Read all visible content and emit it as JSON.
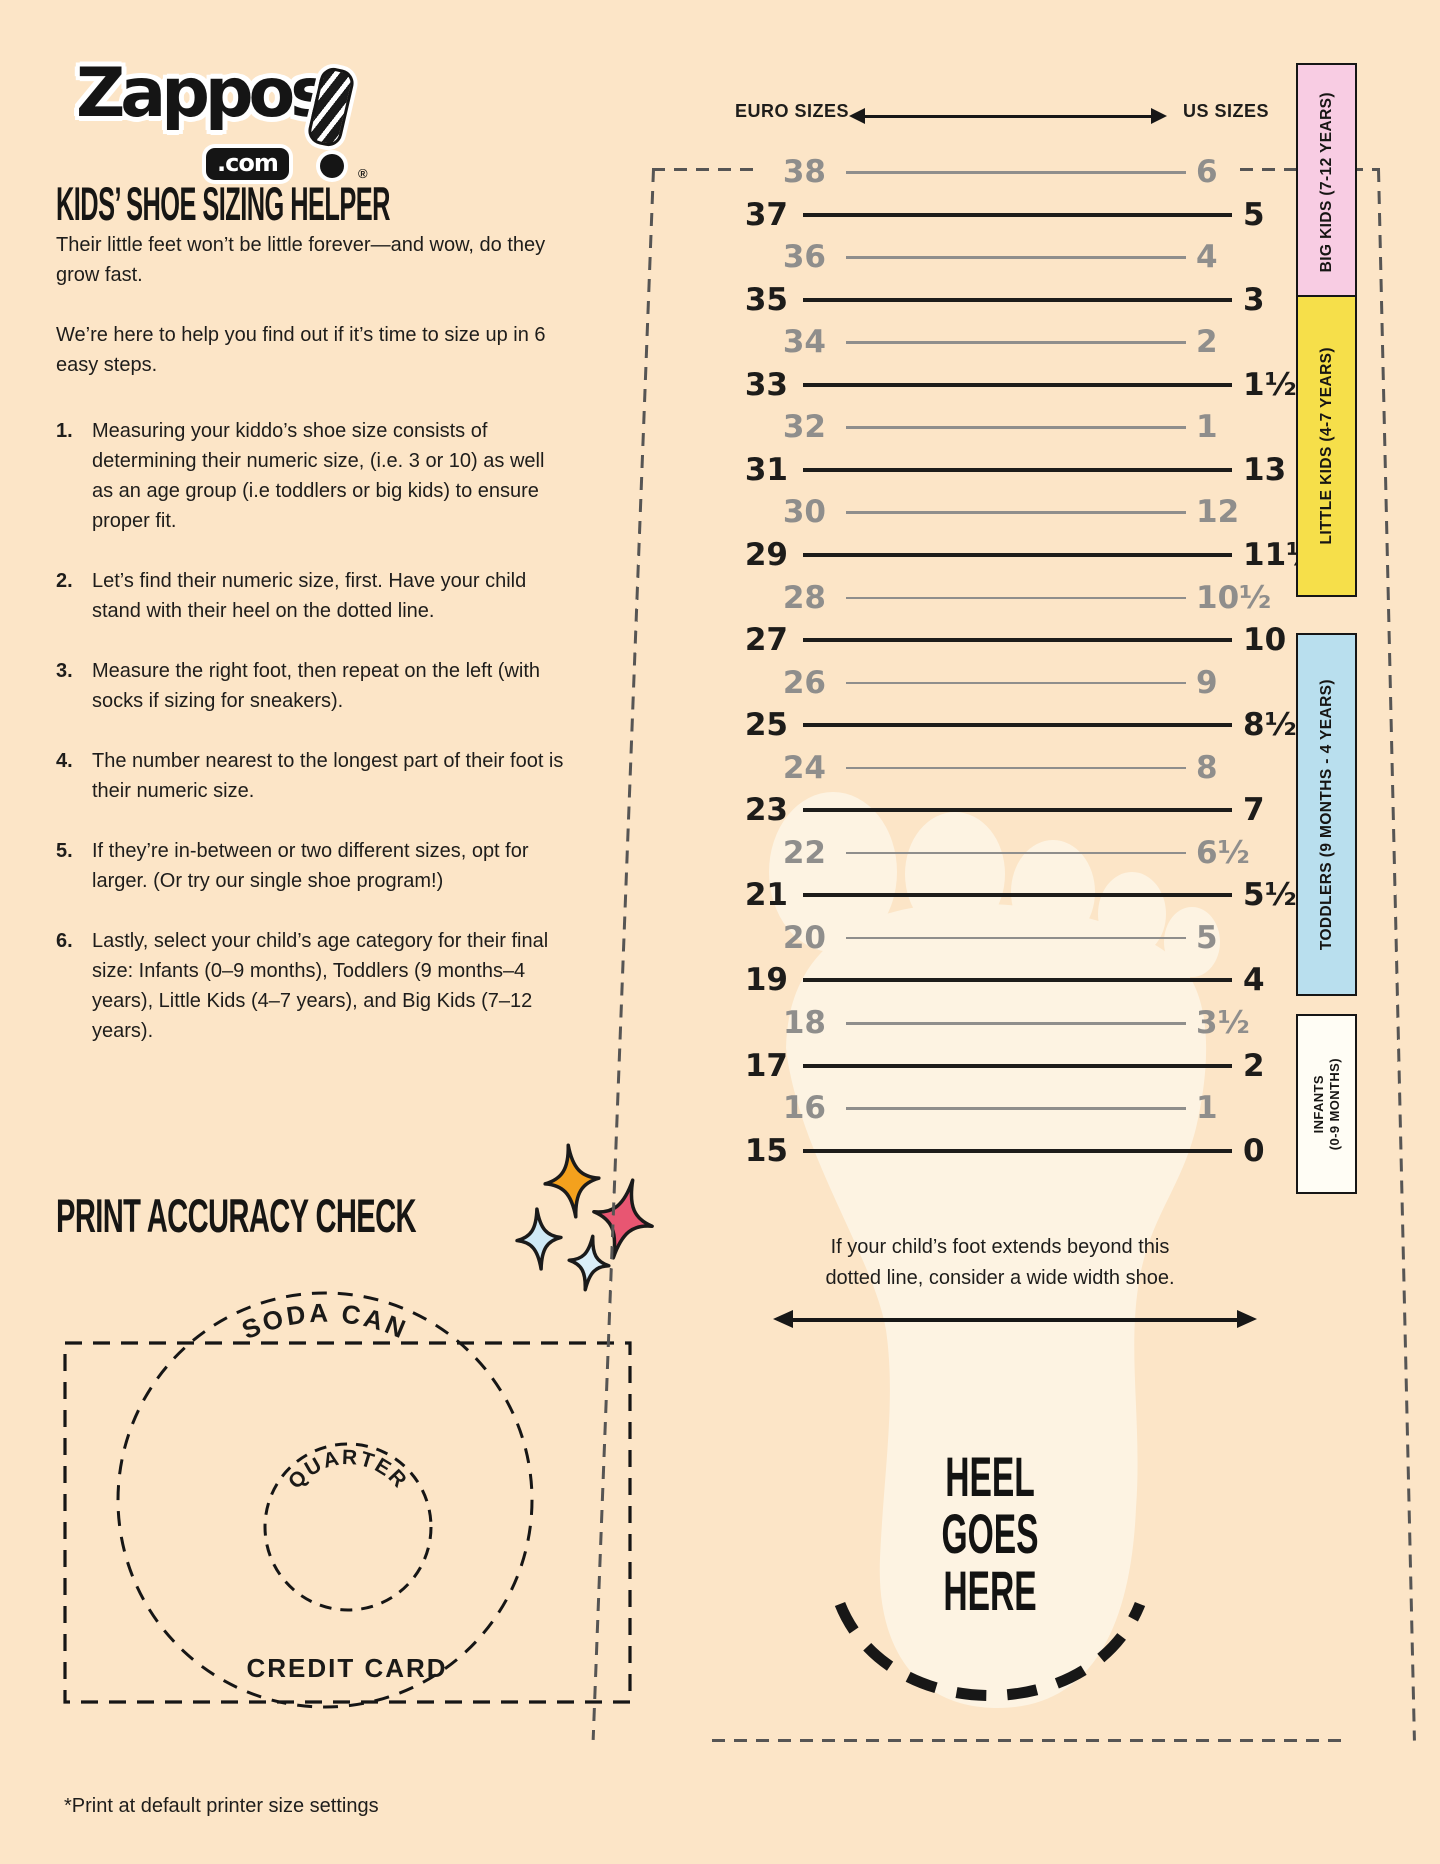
{
  "colors": {
    "background": "#fce5c7",
    "foot": "#fdf3e2",
    "ink": "#1d1c1a",
    "muted_gray": "#8f8e8c"
  },
  "logo": {
    "brand": "Zappos",
    "tld": ".com",
    "registered": "®"
  },
  "left_column": {
    "heading": "KIDS’ SHOE SIZING HELPER",
    "intro": [
      "Their little feet won’t be little forever—and wow, do they\ngrow fast.",
      "We’re here to help you find out if it’s time to size up in 6\neasy steps."
    ],
    "steps": [
      {
        "num": "1.",
        "text": "Measuring your kiddo’s shoe size consists of\ndetermining their numeric size, (i.e. 3 or 10) as well\nas an age group (i.e toddlers or big kids) to ensure\nproper fit."
      },
      {
        "num": "2.",
        "text": "Let’s find their numeric size, first. Have your child\nstand with their heel on the dotted line."
      },
      {
        "num": "3.",
        "text": "Measure the right foot, then repeat on the left (with\nsocks if sizing for sneakers)."
      },
      {
        "num": "4.",
        "text": "The number nearest to the longest part of their foot is\ntheir numeric size."
      },
      {
        "num": "5.",
        "text": "If they’re in-between or two different sizes, opt for\nlarger. (Or try our single shoe program!)"
      },
      {
        "num": "6.",
        "text": "Lastly, select your child’s age category for their final\nsize: Infants (0–9 months), Toddlers (9 months–4\nyears), Little Kids (4–7 years), and Big Kids (7–12\nyears)."
      }
    ],
    "print_check": {
      "heading": "PRINT ACCURACY CHECK",
      "soda_can": "SODA CAN",
      "quarter": "QUARTER",
      "credit_card": "CREDIT CARD"
    },
    "footnote": "*Print at default printer size settings"
  },
  "chart": {
    "euro_header": "EURO SIZES",
    "us_header": "US SIZES",
    "rows": [
      {
        "euro": "38",
        "us": "6",
        "emph": false
      },
      {
        "euro": "37",
        "us": "5",
        "emph": true
      },
      {
        "euro": "36",
        "us": "4",
        "emph": false
      },
      {
        "euro": "35",
        "us": "3",
        "emph": true
      },
      {
        "euro": "34",
        "us": "2",
        "emph": false
      },
      {
        "euro": "33",
        "us": "1½",
        "emph": true
      },
      {
        "euro": "32",
        "us": "1",
        "emph": false
      },
      {
        "euro": "31",
        "us": "13",
        "emph": true
      },
      {
        "euro": "30",
        "us": "12",
        "emph": false
      },
      {
        "euro": "29",
        "us": "11½",
        "emph": true
      },
      {
        "euro": "28",
        "us": "10½",
        "emph": false
      },
      {
        "euro": "27",
        "us": "10",
        "emph": true
      },
      {
        "euro": "26",
        "us": "9",
        "emph": false
      },
      {
        "euro": "25",
        "us": "8½",
        "emph": true
      },
      {
        "euro": "24",
        "us": "8",
        "emph": false
      },
      {
        "euro": "23",
        "us": "7",
        "emph": true
      },
      {
        "euro": "22",
        "us": "6½",
        "emph": false
      },
      {
        "euro": "21",
        "us": "5½",
        "emph": true
      },
      {
        "euro": "20",
        "us": "5",
        "emph": false
      },
      {
        "euro": "19",
        "us": "4",
        "emph": true
      },
      {
        "euro": "18",
        "us": "3½",
        "emph": false
      },
      {
        "euro": "17",
        "us": "2",
        "emph": true
      },
      {
        "euro": "16",
        "us": "1",
        "emph": false
      },
      {
        "euro": "15",
        "us": "0",
        "emph": true
      }
    ],
    "bands": [
      {
        "label": "BIG KIDS (7-12 YEARS)",
        "color": "#f8cce3",
        "top": 63,
        "height": 235
      },
      {
        "label": "LITTLE KIDS (4-7 YEARS)",
        "color": "#f6df4a",
        "top": 295,
        "height": 298
      },
      {
        "label": "TODDLERS (9 MONTHS - 4 YEARS)",
        "color": "#b9dfee",
        "top": 633,
        "height": 359
      },
      {
        "label": "INFANTS",
        "sublabel": "(0-9 MONTHS)",
        "color": "#fffdf5",
        "top": 1014,
        "height": 176,
        "small": true
      }
    ],
    "wide_width_note": "If your child’s foot extends beyond this\ndotted line, consider a wide width shoe.",
    "heel_label": [
      "HEEL",
      "GOES",
      "HERE"
    ]
  },
  "decor": {
    "sparkles": [
      {
        "name": "orange-sparkle",
        "color": "#f4a11d"
      },
      {
        "name": "pink-sparkle",
        "color": "#e85672"
      },
      {
        "name": "blue-sparkle",
        "color": "#cfe9f6"
      },
      {
        "name": "pale-blue-sparkle",
        "color": "#daeef8"
      }
    ]
  }
}
